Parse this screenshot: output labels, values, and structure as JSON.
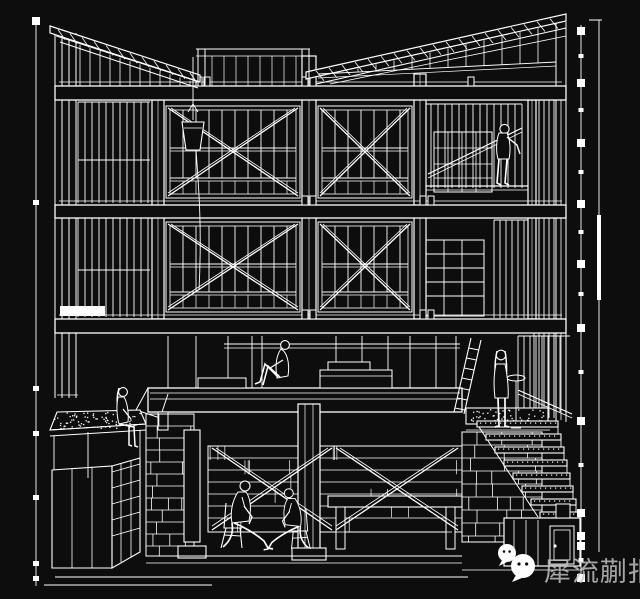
{
  "canvas": {
    "width": 640,
    "height": 599,
    "background": "#0d0d0d",
    "line_color": "#ffffff"
  },
  "watermark": {
    "text": "犀流蒯报",
    "text_color": "#c6c6c6",
    "icons": [
      {
        "name": "wechat-face-icon-small",
        "cx": 13,
        "cy": 11,
        "r": 9
      },
      {
        "name": "wechat-face-icon-large",
        "cx": 29,
        "cy": 24,
        "r": 12
      }
    ]
  },
  "drawing": {
    "label": "axonometric building sectional drawing, white line-work on black",
    "bands": [
      {
        "x1": 55,
        "x2": 566,
        "y": 86,
        "h": 14
      },
      {
        "x1": 55,
        "x2": 566,
        "y": 205,
        "h": 13
      },
      {
        "x1": 55,
        "x2": 566,
        "y": 319,
        "h": 14
      }
    ],
    "columns": [
      [
        152,
        100,
        12,
        219
      ],
      [
        302,
        56,
        14,
        263
      ],
      [
        414,
        74,
        12,
        245
      ],
      [
        528,
        100,
        8,
        219
      ]
    ],
    "window_bays": [
      {
        "x": 166,
        "y": 106,
        "w": 134,
        "h": 92,
        "transom": 148,
        "step": 13,
        "brace": true
      },
      {
        "x": 318,
        "y": 106,
        "w": 94,
        "h": 92,
        "transom": 148,
        "step": 13,
        "brace": true
      },
      {
        "x": 166,
        "y": 222,
        "w": 134,
        "h": 90,
        "transom": 264,
        "step": 13,
        "brace": true
      },
      {
        "x": 318,
        "y": 222,
        "w": 94,
        "h": 90,
        "transom": 264,
        "step": 13,
        "brace": true
      }
    ],
    "siding": [
      {
        "x1": 78,
        "x2": 150,
        "y1": 102,
        "y2": 203,
        "step": 7
      },
      {
        "x1": 78,
        "x2": 150,
        "y1": 218,
        "y2": 317,
        "step": 7
      },
      {
        "x1": 534,
        "x2": 554,
        "y1": 100,
        "y2": 418,
        "step": 5
      },
      {
        "x1": 424,
        "x2": 522,
        "y1": 104,
        "y2": 188,
        "step": 7
      },
      {
        "x1": 494,
        "x2": 530,
        "y1": 220,
        "y2": 318,
        "step": 6
      },
      {
        "x1": 518,
        "x2": 570,
        "y1": 336,
        "y2": 412,
        "step": 6
      }
    ],
    "roof": {
      "left_slope": {
        "x1": 50,
        "y1": 26,
        "x2": 200,
        "y2": 75,
        "thickness": 7
      },
      "right_slope": {
        "x1": 306,
        "y1": 72,
        "x2": 566,
        "y2": 14,
        "thickness": 7
      },
      "clerestory": {
        "x1": 196,
        "x2": 310,
        "y1": 49,
        "y2": 56
      }
    },
    "stairs": {
      "steps": 8,
      "x": 477,
      "y": 421,
      "dx": 9,
      "dy": 13,
      "w": 81,
      "wx": 3
    },
    "dims": {
      "left": {
        "x": 36,
        "y1": 18,
        "y2": 586,
        "squares": [
          17
        ],
        "ticks": [
          200,
          386,
          431,
          495,
          561,
          576
        ]
      },
      "right": {
        "x": 581,
        "y1": 25,
        "y2": 583,
        "squares": [
          27,
          79,
          139,
          200,
          260,
          324,
          417,
          509,
          532,
          542,
          574
        ],
        "ticks": [
          54,
          108,
          170,
          230,
          292,
          370,
          463,
          558
        ]
      },
      "outer": {
        "x": 599,
        "y1": 20,
        "y2": 552,
        "bar_y1": 215,
        "bar_y2": 300
      }
    },
    "people": [
      {
        "pose": "reach",
        "x": 503,
        "y": 186,
        "scale": 1,
        "flip": false,
        "name": "person-on-scaffold"
      },
      {
        "pose": "sitKnees",
        "x": 272,
        "y": 388,
        "scale": 1,
        "flip": false,
        "name": "person-sitting-on-deck"
      },
      {
        "pose": "sitEdge",
        "x": 121,
        "y": 447,
        "scale": 1,
        "flip": false,
        "name": "person-sitting-on-planter"
      },
      {
        "pose": "standBack",
        "x": 501,
        "y": 428,
        "scale": 1,
        "flip": false,
        "name": "person-standing-terrace"
      },
      {
        "pose": "suitMan",
        "x": 237,
        "y": 548,
        "scale": 1,
        "flip": false,
        "name": "person-seated-left"
      },
      {
        "pose": "suitMan",
        "x": 296,
        "y": 549,
        "scale": 0.9,
        "flip": true,
        "name": "person-seated-right"
      }
    ]
  }
}
